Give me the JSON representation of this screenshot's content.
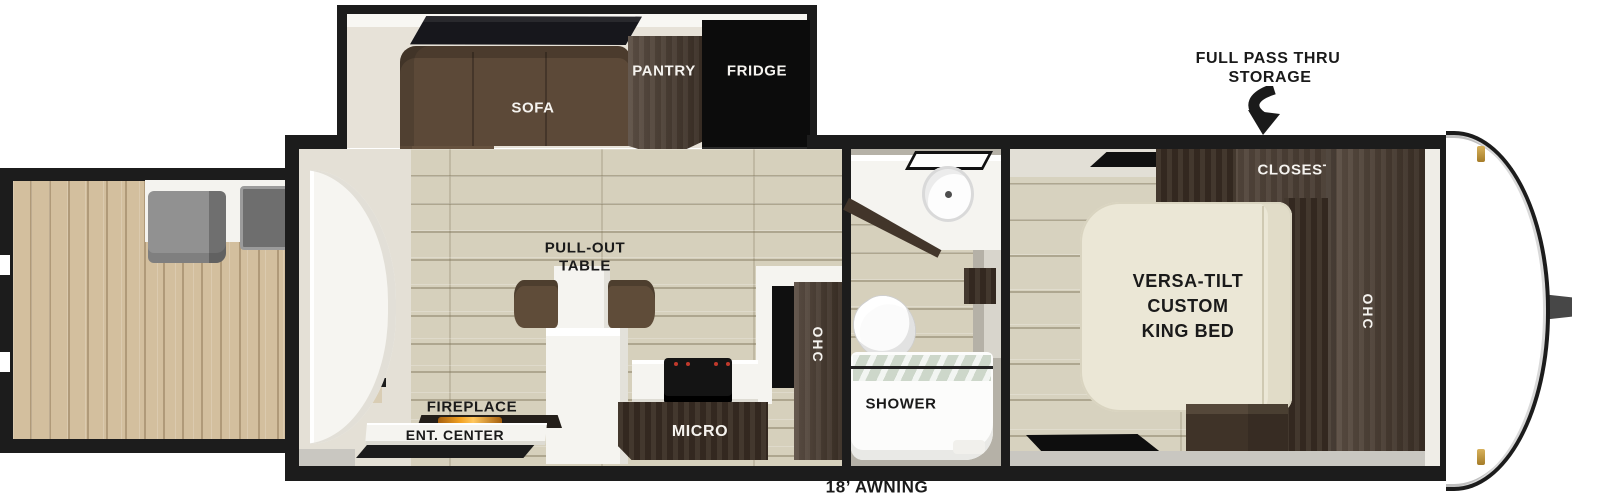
{
  "diagram": {
    "type": "travel-trailer-floorplan",
    "exterior": {
      "storage_label_line1": "FULL PASS THRU",
      "storage_label_line2": "STORAGE",
      "awning_label": "18’ AWNING"
    },
    "slideout": {
      "sofa_label": "SOFA",
      "pantry_label": "PANTRY",
      "fridge_label": "FRIDGE"
    },
    "living_area": {
      "pullout_table_line1": "PULL-OUT",
      "pullout_table_line2": "TABLE",
      "fireplace_label": "FIREPLACE",
      "ent_center_label": "ENT. CENTER",
      "micro_label": "MICRO",
      "ohc_label": "OHC"
    },
    "bathroom": {
      "shower_label": "SHOWER"
    },
    "bedroom": {
      "closet_label": "CLOSEST",
      "bed_line1": "VERSA-TILT",
      "bed_line2": "CUSTOM",
      "bed_line3": "KING BED",
      "ohc_label": "OHC"
    },
    "colors": {
      "walls": "#1c1c1c",
      "floor_plank": "#d6d0bc",
      "deck_plank": "#d3bf9e",
      "cabinet_walnut": "#4b3c30",
      "sofa_brown": "#5c4938",
      "fridge_black": "#0c0c0c",
      "bed_cream": "#ebe7d6",
      "fireplace_flame": "#e8921e",
      "shower_glass": "#cdd7ca",
      "marker_light_gold": "#c59b45",
      "deck_furniture_gray": "#8a8a8a"
    }
  }
}
